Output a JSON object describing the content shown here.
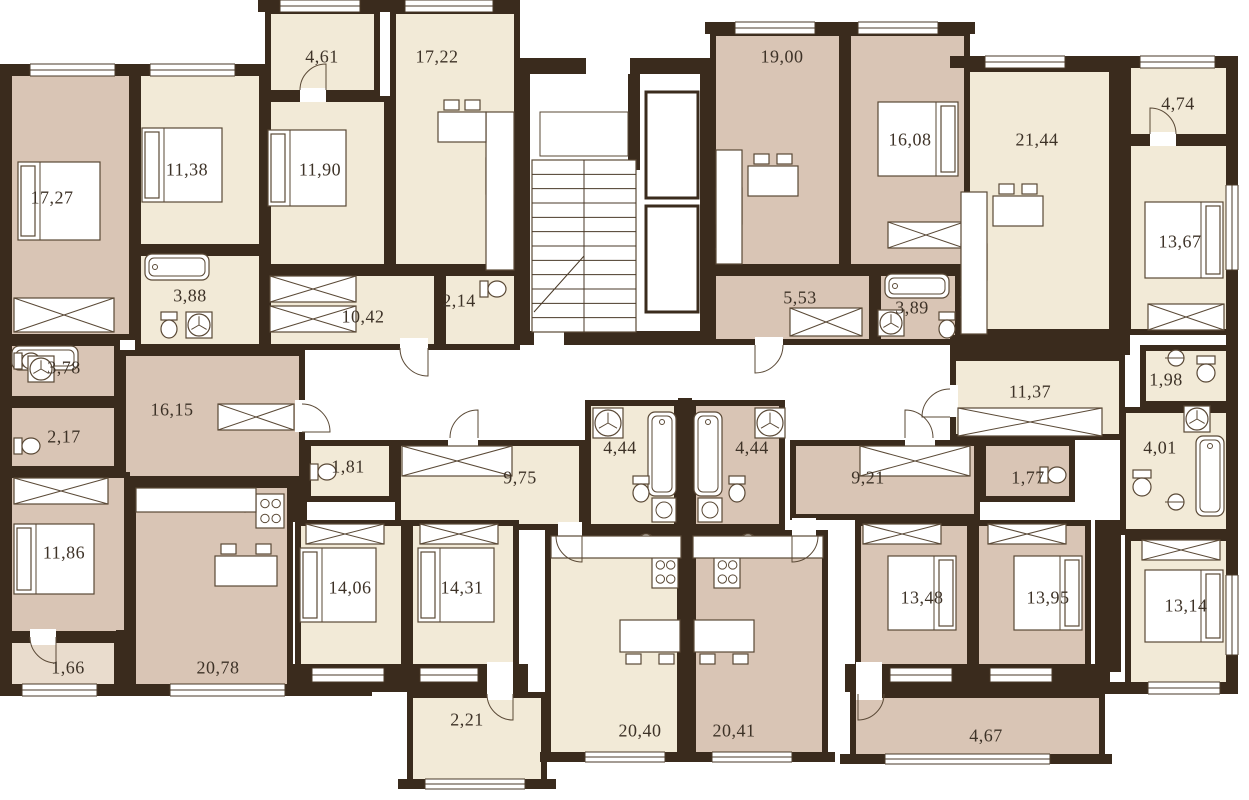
{
  "meta": {
    "width": 1249,
    "height": 800
  },
  "palette": {
    "wall": "#3a2b1d",
    "cream": "#f2ead7",
    "pink": "#d9c5b5",
    "pink_light": "#e9dccd",
    "line": "#5a4936",
    "window_line": "#4a3a28",
    "text": "#3d3227",
    "bg": "#ffffff"
  },
  "labels": [
    {
      "t": "4,61",
      "x": 322,
      "y": 57
    },
    {
      "t": "17,22",
      "x": 437,
      "y": 57
    },
    {
      "t": "19,00",
      "x": 782,
      "y": 57
    },
    {
      "t": "16,08",
      "x": 910,
      "y": 140
    },
    {
      "t": "21,44",
      "x": 1037,
      "y": 140
    },
    {
      "t": "4,74",
      "x": 1178,
      "y": 104
    },
    {
      "t": "17,27",
      "x": 52,
      "y": 198
    },
    {
      "t": "11,38",
      "x": 187,
      "y": 170
    },
    {
      "t": "11,90",
      "x": 320,
      "y": 170
    },
    {
      "t": "13,67",
      "x": 1180,
      "y": 242
    },
    {
      "t": "3,88",
      "x": 190,
      "y": 296
    },
    {
      "t": "10,42",
      "x": 363,
      "y": 317
    },
    {
      "t": "2,14",
      "x": 459,
      "y": 301
    },
    {
      "t": "5,53",
      "x": 800,
      "y": 298
    },
    {
      "t": "3,89",
      "x": 912,
      "y": 308
    },
    {
      "t": "3,78",
      "x": 64,
      "y": 368
    },
    {
      "t": "1,98",
      "x": 1166,
      "y": 380
    },
    {
      "t": "16,15",
      "x": 172,
      "y": 410
    },
    {
      "t": "11,37",
      "x": 1030,
      "y": 392
    },
    {
      "t": "2,17",
      "x": 64,
      "y": 437
    },
    {
      "t": "4,44",
      "x": 620,
      "y": 448
    },
    {
      "t": "4,44",
      "x": 752,
      "y": 448
    },
    {
      "t": "4,01",
      "x": 1160,
      "y": 448
    },
    {
      "t": "1,81",
      "x": 348,
      "y": 467
    },
    {
      "t": "9,75",
      "x": 520,
      "y": 478
    },
    {
      "t": "9,21",
      "x": 868,
      "y": 478
    },
    {
      "t": "1,77",
      "x": 1028,
      "y": 478
    },
    {
      "t": "11,86",
      "x": 64,
      "y": 553
    },
    {
      "t": "14,06",
      "x": 350,
      "y": 588
    },
    {
      "t": "14,31",
      "x": 462,
      "y": 588
    },
    {
      "t": "13,48",
      "x": 922,
      "y": 598
    },
    {
      "t": "13,95",
      "x": 1048,
      "y": 598
    },
    {
      "t": "13,14",
      "x": 1186,
      "y": 606
    },
    {
      "t": "1,66",
      "x": 68,
      "y": 668
    },
    {
      "t": "20,78",
      "x": 218,
      "y": 668
    },
    {
      "t": "2,21",
      "x": 467,
      "y": 720
    },
    {
      "t": "20,40",
      "x": 640,
      "y": 731
    },
    {
      "t": "20,41",
      "x": 734,
      "y": 731
    },
    {
      "t": "4,67",
      "x": 986,
      "y": 736
    }
  ],
  "rooms": [
    {
      "n": "hall-10-42",
      "x": 265,
      "y": 270,
      "w": 175,
      "h": 80,
      "f": "cream"
    },
    {
      "n": "hall-16-15",
      "x": 120,
      "y": 350,
      "w": 185,
      "h": 132,
      "f": "pink"
    },
    {
      "n": "corridor-9-75",
      "x": 395,
      "y": 440,
      "w": 190,
      "h": 90,
      "f": "cream"
    },
    {
      "n": "corridor-9-21",
      "x": 790,
      "y": 440,
      "w": 190,
      "h": 80,
      "f": "pink"
    },
    {
      "n": "hall-11-37",
      "x": 950,
      "y": 355,
      "w": 175,
      "h": 85,
      "f": "cream"
    },
    {
      "n": "hall-5-53",
      "x": 710,
      "y": 270,
      "w": 165,
      "h": 75,
      "f": "pink"
    },
    {
      "n": "bath-3-88",
      "x": 135,
      "y": 250,
      "w": 130,
      "h": 100,
      "f": "cream"
    },
    {
      "n": "wc-2-14",
      "x": 440,
      "y": 270,
      "w": 80,
      "h": 80,
      "f": "cream"
    },
    {
      "n": "bath-3-78",
      "x": 5,
      "y": 340,
      "w": 115,
      "h": 62,
      "f": "pink"
    },
    {
      "n": "wc-2-17",
      "x": 5,
      "y": 402,
      "w": 115,
      "h": 70,
      "f": "pink"
    },
    {
      "n": "wc-1-81",
      "x": 305,
      "y": 440,
      "w": 90,
      "h": 62,
      "f": "cream"
    },
    {
      "n": "bath-4-44-left",
      "x": 585,
      "y": 400,
      "w": 95,
      "h": 130,
      "f": "cream"
    },
    {
      "n": "bath-4-44-right",
      "x": 690,
      "y": 400,
      "w": 95,
      "h": 130,
      "f": "pink"
    },
    {
      "n": "wc-1-77",
      "x": 980,
      "y": 440,
      "w": 95,
      "h": 62,
      "f": "pink"
    },
    {
      "n": "wc-1-98",
      "x": 1140,
      "y": 345,
      "w": 92,
      "h": 62,
      "f": "cream"
    },
    {
      "n": "bath-4-01",
      "x": 1120,
      "y": 407,
      "w": 112,
      "h": 128,
      "f": "cream"
    },
    {
      "n": "bath-3-89",
      "x": 875,
      "y": 270,
      "w": 95,
      "h": 75,
      "f": "pink"
    },
    {
      "n": "room-17-27",
      "x": 5,
      "y": 70,
      "w": 130,
      "h": 270,
      "f": "pink"
    },
    {
      "n": "room-11-38",
      "x": 135,
      "y": 70,
      "w": 130,
      "h": 180,
      "f": "cream"
    },
    {
      "n": "room-11-90",
      "x": 265,
      "y": 96,
      "w": 125,
      "h": 174,
      "f": "cream"
    },
    {
      "n": "kitchen-17-22",
      "x": 390,
      "y": 8,
      "w": 130,
      "h": 262,
      "f": "cream"
    },
    {
      "n": "room-11-86",
      "x": 5,
      "y": 472,
      "w": 125,
      "h": 165,
      "f": "pink"
    },
    {
      "n": "kitchen-20-78",
      "x": 130,
      "y": 482,
      "w": 163,
      "h": 210,
      "f": "pink"
    },
    {
      "n": "room-14-06",
      "x": 295,
      "y": 520,
      "w": 112,
      "h": 150,
      "f": "cream"
    },
    {
      "n": "room-14-31",
      "x": 407,
      "y": 520,
      "w": 112,
      "h": 150,
      "f": "cream"
    },
    {
      "n": "kitchen-20-40",
      "x": 545,
      "y": 530,
      "w": 138,
      "h": 228,
      "f": "cream"
    },
    {
      "n": "kitchen-20-41",
      "x": 690,
      "y": 530,
      "w": 138,
      "h": 228,
      "f": "pink"
    },
    {
      "n": "room-13-48",
      "x": 855,
      "y": 520,
      "w": 118,
      "h": 152,
      "f": "pink"
    },
    {
      "n": "room-13-95",
      "x": 973,
      "y": 520,
      "w": 118,
      "h": 152,
      "f": "pink"
    },
    {
      "n": "room-13-14",
      "x": 1125,
      "y": 535,
      "w": 110,
      "h": 153,
      "f": "cream"
    },
    {
      "n": "kitchen-21-44",
      "x": 955,
      "y": 66,
      "w": 160,
      "h": 269,
      "f": "cream"
    },
    {
      "n": "room-13-67",
      "x": 1125,
      "y": 140,
      "w": 108,
      "h": 195,
      "f": "cream"
    },
    {
      "n": "kitchen-19-00",
      "x": 710,
      "y": 30,
      "w": 135,
      "h": 240,
      "f": "pink"
    },
    {
      "n": "room-16-08",
      "x": 845,
      "y": 30,
      "w": 125,
      "h": 240,
      "f": "pink"
    },
    {
      "n": "balcony-4-61",
      "x": 265,
      "y": 8,
      "w": 115,
      "h": 88,
      "f": "cream"
    },
    {
      "n": "balcony-4-74",
      "x": 1125,
      "y": 62,
      "w": 108,
      "h": 78,
      "f": "cream"
    },
    {
      "n": "balcony-1-66",
      "x": 5,
      "y": 637,
      "w": 115,
      "h": 55,
      "f": "pink_light"
    },
    {
      "n": "balcony-2-21",
      "x": 407,
      "y": 692,
      "w": 140,
      "h": 95,
      "f": "cream"
    },
    {
      "n": "balcony-4-67",
      "x": 850,
      "y": 692,
      "w": 255,
      "h": 68,
      "f": "pink"
    }
  ],
  "walls": [
    [
      0,
      64,
      265,
      12
    ],
    [
      258,
      0,
      262,
      12
    ],
    [
      705,
      22,
      270,
      12
    ],
    [
      950,
      56,
      285,
      12
    ],
    [
      0,
      64,
      12,
      628
    ],
    [
      0,
      684,
      372,
      12
    ],
    [
      1226,
      56,
      12,
      638
    ],
    [
      1098,
      682,
      140,
      12
    ],
    [
      398,
      779,
      158,
      10
    ],
    [
      540,
      752,
      295,
      10
    ],
    [
      840,
      754,
      272,
      10
    ],
    [
      288,
      664,
      240,
      28
    ],
    [
      845,
      664,
      265,
      28
    ],
    [
      116,
      630,
      16,
      62
    ],
    [
      950,
      335,
      180,
      20
    ],
    [
      678,
      398,
      14,
      360
    ],
    [
      1113,
      62,
      14,
      273
    ],
    [
      1095,
      520,
      26,
      152
    ],
    [
      293,
      482,
      14,
      40
    ],
    [
      516,
      58,
      14,
      287
    ],
    [
      700,
      58,
      14,
      287
    ],
    [
      516,
      58,
      70,
      16
    ],
    [
      630,
      58,
      84,
      16
    ],
    [
      516,
      331,
      18,
      14
    ],
    [
      564,
      331,
      150,
      14
    ],
    [
      628,
      74,
      12,
      96
    ]
  ],
  "gaps": [
    [
      400,
      338,
      28,
      16
    ],
    [
      295,
      400,
      14,
      32
    ],
    [
      448,
      432,
      30,
      16
    ],
    [
      905,
      432,
      30,
      16
    ],
    [
      944,
      385,
      14,
      32
    ],
    [
      755,
      337,
      28,
      16
    ],
    [
      300,
      88,
      26,
      14
    ],
    [
      30,
      629,
      26,
      16
    ],
    [
      487,
      662,
      26,
      38
    ],
    [
      856,
      662,
      26,
      38
    ],
    [
      1150,
      132,
      26,
      14
    ],
    [
      558,
      522,
      24,
      16
    ],
    [
      792,
      518,
      24,
      20
    ]
  ],
  "windows": [
    [
      30,
      64,
      85,
      12
    ],
    [
      150,
      64,
      85,
      12
    ],
    [
      280,
      0,
      80,
      12
    ],
    [
      405,
      0,
      88,
      12
    ],
    [
      735,
      22,
      80,
      12
    ],
    [
      858,
      22,
      80,
      12
    ],
    [
      985,
      56,
      80,
      12
    ],
    [
      1140,
      56,
      75,
      12
    ],
    [
      1226,
      185,
      12,
      85
    ],
    [
      1226,
      575,
      12,
      80
    ],
    [
      22,
      684,
      75,
      12
    ],
    [
      170,
      684,
      115,
      12
    ],
    [
      312,
      668,
      72,
      14
    ],
    [
      420,
      668,
      58,
      14
    ],
    [
      425,
      779,
      100,
      10
    ],
    [
      585,
      752,
      80,
      10
    ],
    [
      712,
      752,
      80,
      10
    ],
    [
      885,
      754,
      165,
      10
    ],
    [
      1148,
      682,
      72,
      12
    ],
    [
      890,
      668,
      62,
      14
    ],
    [
      990,
      668,
      62,
      14
    ]
  ],
  "furniture": [
    [
      "bed",
      18,
      162,
      82,
      78,
      "l"
    ],
    [
      "bed",
      142,
      128,
      80,
      74,
      "l"
    ],
    [
      "bed",
      268,
      130,
      78,
      76,
      "l"
    ],
    [
      "bed",
      878,
      102,
      80,
      74,
      "r"
    ],
    [
      "bed",
      1145,
      202,
      78,
      76,
      "r"
    ],
    [
      "bed",
      14,
      524,
      80,
      70,
      "l"
    ],
    [
      "bed",
      300,
      548,
      76,
      74,
      "l"
    ],
    [
      "bed",
      418,
      548,
      76,
      74,
      "l"
    ],
    [
      "bed",
      888,
      556,
      68,
      74,
      "r"
    ],
    [
      "bed",
      1014,
      556,
      68,
      74,
      "r"
    ],
    [
      "bed",
      1145,
      570,
      78,
      72,
      "r"
    ],
    [
      "wrd",
      14,
      298,
      100,
      34
    ],
    [
      "wrd",
      270,
      276,
      86,
      26
    ],
    [
      "wrd",
      270,
      306,
      86,
      26
    ],
    [
      "wrd",
      218,
      404,
      76,
      26
    ],
    [
      "wrd",
      14,
      478,
      94,
      26
    ],
    [
      "wrd",
      402,
      446,
      110,
      30
    ],
    [
      "wrd",
      860,
      446,
      110,
      30
    ],
    [
      "wrd",
      958,
      408,
      144,
      28
    ],
    [
      "wrd",
      888,
      222,
      76,
      26
    ],
    [
      "wrd",
      1148,
      304,
      76,
      26
    ],
    [
      "wrd",
      306,
      524,
      78,
      20
    ],
    [
      "wrd",
      420,
      524,
      78,
      20
    ],
    [
      "wrd",
      863,
      524,
      78,
      20
    ],
    [
      "wrd",
      988,
      524,
      78,
      20
    ],
    [
      "wrd",
      1142,
      540,
      78,
      20
    ],
    [
      "wrd",
      790,
      308,
      72,
      28
    ],
    [
      "tub",
      145,
      254,
      64,
      26
    ],
    [
      "tub",
      12,
      346,
      66,
      24
    ],
    [
      "tub",
      648,
      412,
      28,
      84
    ],
    [
      "tub",
      694,
      412,
      28,
      84
    ],
    [
      "tub",
      885,
      274,
      64,
      24
    ],
    [
      "tub",
      1196,
      436,
      28,
      80
    ],
    [
      "wc",
      480,
      280,
      26,
      18,
      "h"
    ],
    [
      "wc",
      160,
      312,
      18,
      26,
      "v"
    ],
    [
      "wc",
      14,
      352,
      26,
      18,
      "h"
    ],
    [
      "wc",
      14,
      437,
      26,
      18,
      "h"
    ],
    [
      "wc",
      310,
      463,
      26,
      18,
      "h"
    ],
    [
      "wc",
      1040,
      466,
      26,
      18,
      "h"
    ],
    [
      "wc",
      1196,
      356,
      20,
      26,
      "v"
    ],
    [
      "wc",
      632,
      476,
      18,
      26,
      "v"
    ],
    [
      "wc",
      728,
      476,
      18,
      26,
      "v"
    ],
    [
      "wc",
      938,
      312,
      18,
      26,
      "v"
    ],
    [
      "wc",
      1132,
      470,
      20,
      26,
      "v"
    ],
    [
      "fan",
      188,
      314,
      22
    ],
    [
      "fan",
      30,
      358,
      22
    ],
    [
      "fan",
      595,
      410,
      26
    ],
    [
      "fan",
      757,
      410,
      26
    ],
    [
      "fan",
      880,
      312,
      22
    ],
    [
      "fan",
      1186,
      408,
      22
    ],
    [
      "snk",
      490,
      206,
      22
    ],
    [
      "snk",
      718,
      238,
      22
    ],
    [
      "snk",
      963,
      286,
      22
    ],
    [
      "snk",
      234,
      490,
      22
    ],
    [
      "snk",
      636,
      534,
      20
    ],
    [
      "snk",
      738,
      534,
      20
    ],
    [
      "snk",
      1168,
      350,
      16
    ],
    [
      "snk",
      1168,
      494,
      16
    ],
    [
      "stv",
      486,
      158,
      28,
      36
    ],
    [
      "stv",
      716,
      188,
      26,
      36
    ],
    [
      "stv",
      961,
      244,
      26,
      36
    ],
    [
      "stv",
      256,
      494,
      28,
      34
    ],
    [
      "stv",
      652,
      556,
      26,
      32
    ],
    [
      "stv",
      714,
      556,
      26,
      32
    ],
    [
      "cnt",
      486,
      112,
      28,
      158
    ],
    [
      "cnt",
      716,
      150,
      26,
      114
    ],
    [
      "cnt",
      961,
      192,
      26,
      142
    ],
    [
      "cnt",
      136,
      488,
      120,
      24
    ],
    [
      "cnt",
      551,
      536,
      130,
      22
    ],
    [
      "cnt",
      693,
      536,
      130,
      22
    ],
    [
      "wsh",
      652,
      498,
      24,
      24
    ],
    [
      "wsh",
      698,
      498,
      24,
      24
    ],
    [
      "tbl",
      438,
      112,
      48,
      30,
      "n"
    ],
    [
      "tbl",
      748,
      166,
      50,
      30,
      "n"
    ],
    [
      "tbl",
      993,
      196,
      50,
      30,
      "n"
    ],
    [
      "tbl",
      215,
      556,
      62,
      30,
      "n"
    ],
    [
      "tbl",
      620,
      620,
      60,
      32,
      "s"
    ],
    [
      "tbl",
      694,
      620,
      60,
      32,
      "s"
    ]
  ],
  "stairs": {
    "x": 532,
    "y": 160,
    "w": 104,
    "h": 172,
    "steps": 12,
    "landing": [
      540,
      112,
      88,
      44
    ]
  },
  "elevators": [
    [
      646,
      92,
      52,
      106
    ],
    [
      646,
      206,
      52,
      106
    ]
  ],
  "arcs": [
    "M428 348 L428 376 A28 28 0 0 1 400 348",
    "M302 432 L330 432 A28 28 0 0 0 302 404",
    "M478 438 L478 410 A28 28 0 0 0 450 438",
    "M905 438 L905 410 A28 28 0 0 1 933 438",
    "M950 417 L922 417 A28 28 0 0 1 950 389",
    "M755 345 L755 373 A28 28 0 0 0 783 345",
    "M1150 134 L1150 108 A26 26 0 0 1 1176 134",
    "M326 90 L326 64 A26 26 0 0 0 300 90",
    "M56 637 L56 663 A26 26 0 0 1 30 637",
    "M513 694 L513 720 A26 26 0 0 1 487 694",
    "M858 694 L858 720 A26 26 0 0 0 884 694",
    "M582 536 L582 562 A26 26 0 0 1 556 536",
    "M792 536 L792 562 A26 26 0 0 0 818 536"
  ]
}
